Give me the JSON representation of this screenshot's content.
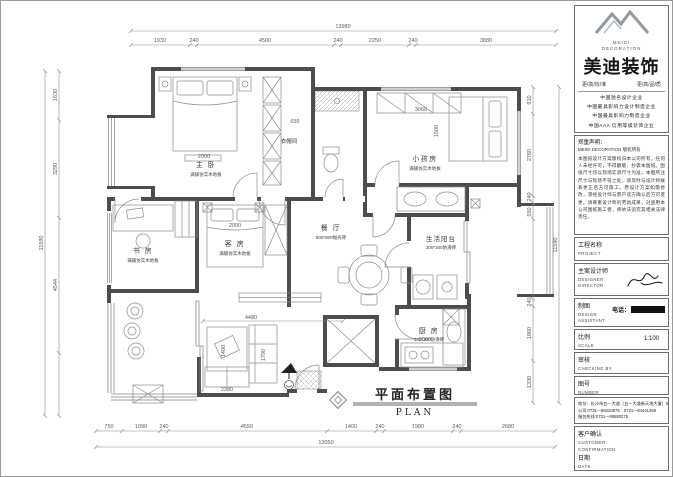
{
  "sidebar": {
    "logo": {
      "brand_en_1": "MEIDI",
      "brand_en_2": "DECORATION",
      "brand_cn": "美迪装饰",
      "tagline_left": "更/高/标/准",
      "tagline_right": "更/高/品/质"
    },
    "credentials": [
      "中国驰名设计企业",
      "中国最具影响力设计制造企业",
      "中国最具影响力制造企业",
      "中国AAA 信用等级装饰企业",
      "中国装修质量示范工（PI）类企业",
      "中国现代装饰品质奖企业"
    ],
    "declaration": {
      "title": "郑重声明：",
      "brand": "MEIDI DECORATION 版权所有",
      "body": "本图纸设计方案版权归本公司所有，任何人未经许可，不得翻版、抄袭本图纸。图纸尺寸均以现场实测尺寸为准，本图所注尺寸与现场不符之处，请及时与设计师联系更正后方可施工。原设计方案如需修改，须经设计师与客户双方确认后方可变更。请尊重设计师的劳动成果，对盗用本公司图纸施工者，将依法追究其相关法律责任。"
    },
    "fields": [
      {
        "label_cn": "工程名称",
        "label_en": "PROJECT"
      },
      {
        "label_cn": "主案设计师",
        "label_en_1": "DESIGNER",
        "label_en_2": "DIRECTOR"
      },
      {
        "label_cn": "制图",
        "label_en_1": "DESIGN",
        "label_en_2": "ASSISTANT",
        "phone_label": "电话："
      },
      {
        "label_cn": "比例",
        "label_en": "SCALE",
        "value": "1:100"
      },
      {
        "label_cn": "审核",
        "label_en": "CHECKING BY"
      },
      {
        "label_cn": "图号",
        "label_en": "NUMBER"
      }
    ],
    "address": {
      "line1": "地址：长沙市五一大道（五一大道新天地大厦）5楼",
      "line2": "公司:0731—88220878　0731—84441259",
      "line3": "服务热线:0731—88890275"
    },
    "customer": {
      "label_cn": "客户确认",
      "label_en_1": "CUSTOMER",
      "label_en_2": "CONFIRMATION",
      "date_cn": "日期",
      "date_en": "DATE"
    }
  },
  "plan": {
    "title_cn": "平面布置图",
    "title_en": "PLAN",
    "rooms": {
      "master": {
        "name": "主 卧",
        "note": "满铺仿实木地板"
      },
      "cloak": {
        "name": "衣帽间"
      },
      "kids": {
        "name": "小孩房",
        "note": "满铺仿实木地板"
      },
      "study": {
        "name": "书 房",
        "note": "满铺仿实木地板"
      },
      "guest": {
        "name": "客 房",
        "note": "满铺仿实木地板"
      },
      "dining": {
        "name": "餐 厅",
        "note": "800*800抛光砖"
      },
      "kitchen": {
        "name": "厨 房",
        "note": "300*300防滑砖"
      },
      "service": {
        "name": "生活阳台",
        "note": "300*300防滑砖"
      }
    },
    "dims": {
      "top_total": "13980",
      "top": [
        "1930",
        "240",
        "4500",
        "240",
        "2250",
        "240",
        "3880"
      ],
      "bottom": [
        "750",
        "1090",
        "240",
        "4550",
        "1400",
        "240",
        "1980",
        "240",
        "2680"
      ],
      "bottom_total": "13050",
      "left": [
        "1630",
        "3290",
        "4544"
      ],
      "left_total": "11590",
      "right": [
        "910",
        "2760",
        "240",
        "550",
        "240",
        "1860",
        "1330"
      ],
      "right_total": "11590"
    },
    "furn": {
      "master_bed": "2000",
      "cloak_w": "655",
      "kids_bed": "3060",
      "kids_bed_depth": "1500",
      "guest_bed": "2000",
      "living_width": "4480",
      "rug": "1400",
      "sofa_len": "1790",
      "sofa": "2380",
      "kitchen_counter": "2000",
      "kitchen_depth": "900"
    }
  }
}
